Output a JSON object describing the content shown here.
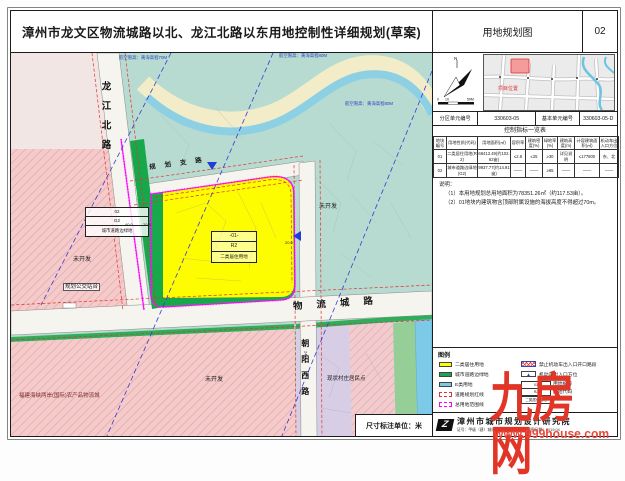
{
  "header": {
    "title": "漳州市龙文区物流城路以北、龙江北路以东用地控制性详细规划(草案)",
    "drawing_name": "用地规划图",
    "sheet_no": "02"
  },
  "map": {
    "roads": {
      "longjiang_north": "龙江北路",
      "wuliucheng": "物流城路",
      "chaoyang_west": "朝阳西路",
      "planned_branch": "规划支路"
    },
    "airspace": {
      "limit70": "航空限高：黄海高程70M",
      "limit80": "航空限高：黄海高程80M",
      "limit80b": "航空限高：黄海高程80M"
    },
    "parcel01": {
      "no": "-01-",
      "code": "R2",
      "use": "二类居住用地"
    },
    "parcel02": {
      "no": "02",
      "code": "G2",
      "use": "城市道路边绿地"
    },
    "labels": {
      "undeveloped": "未开发",
      "bus_stop": "规划公交站台",
      "logistics_city": "福建海峡两岸(国际)农产品物流城",
      "village": "现状村庄居民点"
    },
    "dimensions": {
      "d1": "40.0",
      "d2": "20.5",
      "d3": "20.0",
      "d4": "24.0"
    },
    "scale_bar": {
      "t0": "0",
      "t1": "10",
      "t2": "50M"
    },
    "compass": {
      "north": "N"
    },
    "unit_note": "尺寸标注单位：米"
  },
  "panel": {
    "minimap": {
      "marker": "项目位置"
    },
    "unit_row": {
      "zone_label": "分区单元编号",
      "zone_value": "330603-05",
      "basic_label": "基本单元编号",
      "basic_value": "330603-05-D"
    },
    "table": {
      "title": "控制指标一览表",
      "headers": [
        "地块编号",
        "用地性质(代码)",
        "用地面积(㎡)",
        "容积率",
        "建筑密度(%)",
        "绿地率(%)",
        "建筑高度(m)",
        "计容建筑面积(㎡)",
        "机动车出入口方位"
      ],
      "rows": [
        [
          "01",
          "二类居住用地(R2)",
          "68413.49(约102.62亩)",
          "≤2.6",
          "≤25",
          "≥30",
          "详见说明",
          "≤177800",
          "东、北"
        ],
        [
          "02",
          "城市道路边绿地(G2)",
          "9937.77(约14.91亩)",
          "——",
          "——",
          "≥65",
          "——",
          "——",
          "——"
        ]
      ]
    },
    "notes": {
      "heading": "说明：",
      "line1": "（1）本用地规划总用地面积为78351.26㎡（约117.53亩）。",
      "line2": "（2）01地块内建筑物含顶部附属设施的海拔高度不得超过70m。"
    },
    "legend": {
      "title": "图例",
      "items": [
        {
          "label": "二类居住用地",
          "color": "#fdfd00"
        },
        {
          "label": "城市道路边绿地",
          "color": "#17a84b"
        },
        {
          "label": "E类用地",
          "color": "#7cc9e8"
        },
        {
          "label": "道路规划红线",
          "color": "#e23232"
        },
        {
          "label": "总用地范围线",
          "color": "#ff00ff"
        }
      ],
      "marks": [
        {
          "label": "禁止机动车出入口开口路段"
        },
        {
          "label": "机动车出入口方位",
          "icon": "▲"
        }
      ],
      "key_table": [
        {
          "cell": "01",
          "label": "用地编号"
        },
        {
          "cell": "R2",
          "label": "用地代码"
        },
        {
          "cell": "二类居住用地",
          "label": "用地性质"
        }
      ]
    },
    "institute": {
      "name": "漳州市城市规划设计研究院",
      "cert": "证号：甲级（建）城规编（141046）",
      "date": "制图日期：2019.04",
      "logo": "Z"
    }
  },
  "watermark": {
    "text": "九房网",
    "url": "www.999house.com"
  },
  "colors": {
    "residential_yellow": "#fdfd00",
    "road_green": "#17a84b",
    "water_blue": "#7cc9e8",
    "red_line": "#e23232",
    "site_boundary_magenta": "#ff00ff",
    "airspace_blue": "#3a3ad2",
    "watermark_red": "#e03527"
  }
}
